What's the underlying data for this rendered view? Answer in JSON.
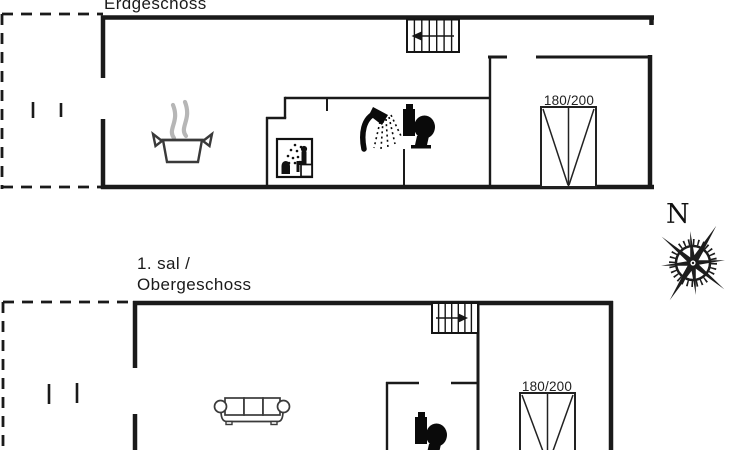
{
  "meta": {
    "type": "vacation-house-floor-plan",
    "background": "#ffffff"
  },
  "floors": [
    {
      "id": "erdgeschoss",
      "title": "Erdgeschoss",
      "bed_label": "180/200",
      "icons": [
        "stairs-icon",
        "cooking-pot-icon",
        "sauna-icon",
        "shower-icon",
        "toilet-icon",
        "double-bed-symbol",
        "terrace-dashed-outline",
        "window-marks"
      ]
    },
    {
      "id": "obergeschoss",
      "title_line1": "1. sal /",
      "title_line2": "Obergeschoss",
      "bed_label": "180/200",
      "icons": [
        "stairs-icon",
        "sofa-icon",
        "toilet-icon",
        "double-bed-symbol",
        "balcony-dashed-outline",
        "window-marks"
      ]
    }
  ],
  "compass": {
    "north_label": "N"
  },
  "colors": {
    "wall": "#1a1a1a",
    "icon_black": "#0a0a0a",
    "steam_gray": "#b6b6b6",
    "furniture_gray": "#3a3a3a",
    "background": "#ffffff"
  }
}
